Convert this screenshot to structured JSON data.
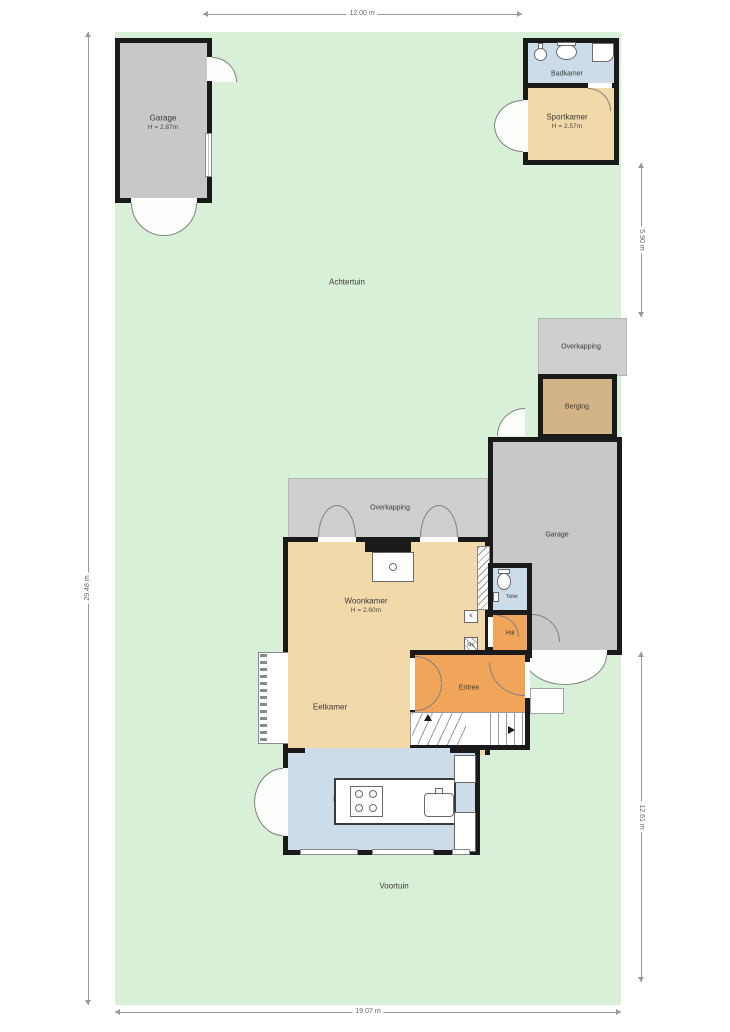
{
  "meta": {
    "type": "floor-plan-with-garden"
  },
  "garden": {
    "achtertuin": "Achtertuin",
    "voortuin": "Voortuin"
  },
  "rooms": {
    "garage_nw": {
      "name": "Garage",
      "height": "H = 2.87m"
    },
    "badkamer": {
      "name": "Badkamer"
    },
    "sportkamer": {
      "name": "Sportkamer",
      "height": "H = 2.57m"
    },
    "overkapping_e": {
      "name": "Overkapping"
    },
    "berging": {
      "name": "Berging"
    },
    "garage_e": {
      "name": "Garage"
    },
    "overkapping_n": {
      "name": "Overkapping"
    },
    "woonkamer": {
      "name": "Woonkamer",
      "height": "H = 2.60m"
    },
    "eetkamer": {
      "name": "Eetkamer"
    },
    "toilet": {
      "name": "Toilet"
    },
    "hal": {
      "name": "Hal"
    },
    "kast": {
      "name": "K"
    },
    "meterkast": {
      "name": "MK"
    },
    "entree": {
      "name": "Entree"
    },
    "keuken": {
      "name": "Keuken"
    }
  },
  "dimensions": {
    "top": "12.00 m",
    "right_upper": "5.90 m",
    "right_lower": "12.61 m",
    "left": "29.48 m",
    "bottom": "19.07 m"
  },
  "colors": {
    "garden": "#d9f0d8",
    "wall": "#1a1a1a",
    "living_rooms": "#f2d9a9",
    "circulation_rooms": "#f0a55b",
    "wet_rooms": "#ccdde9",
    "garage": "#c8c8c8",
    "canopy": "#cfcfcf",
    "storage": "#d3b488"
  }
}
